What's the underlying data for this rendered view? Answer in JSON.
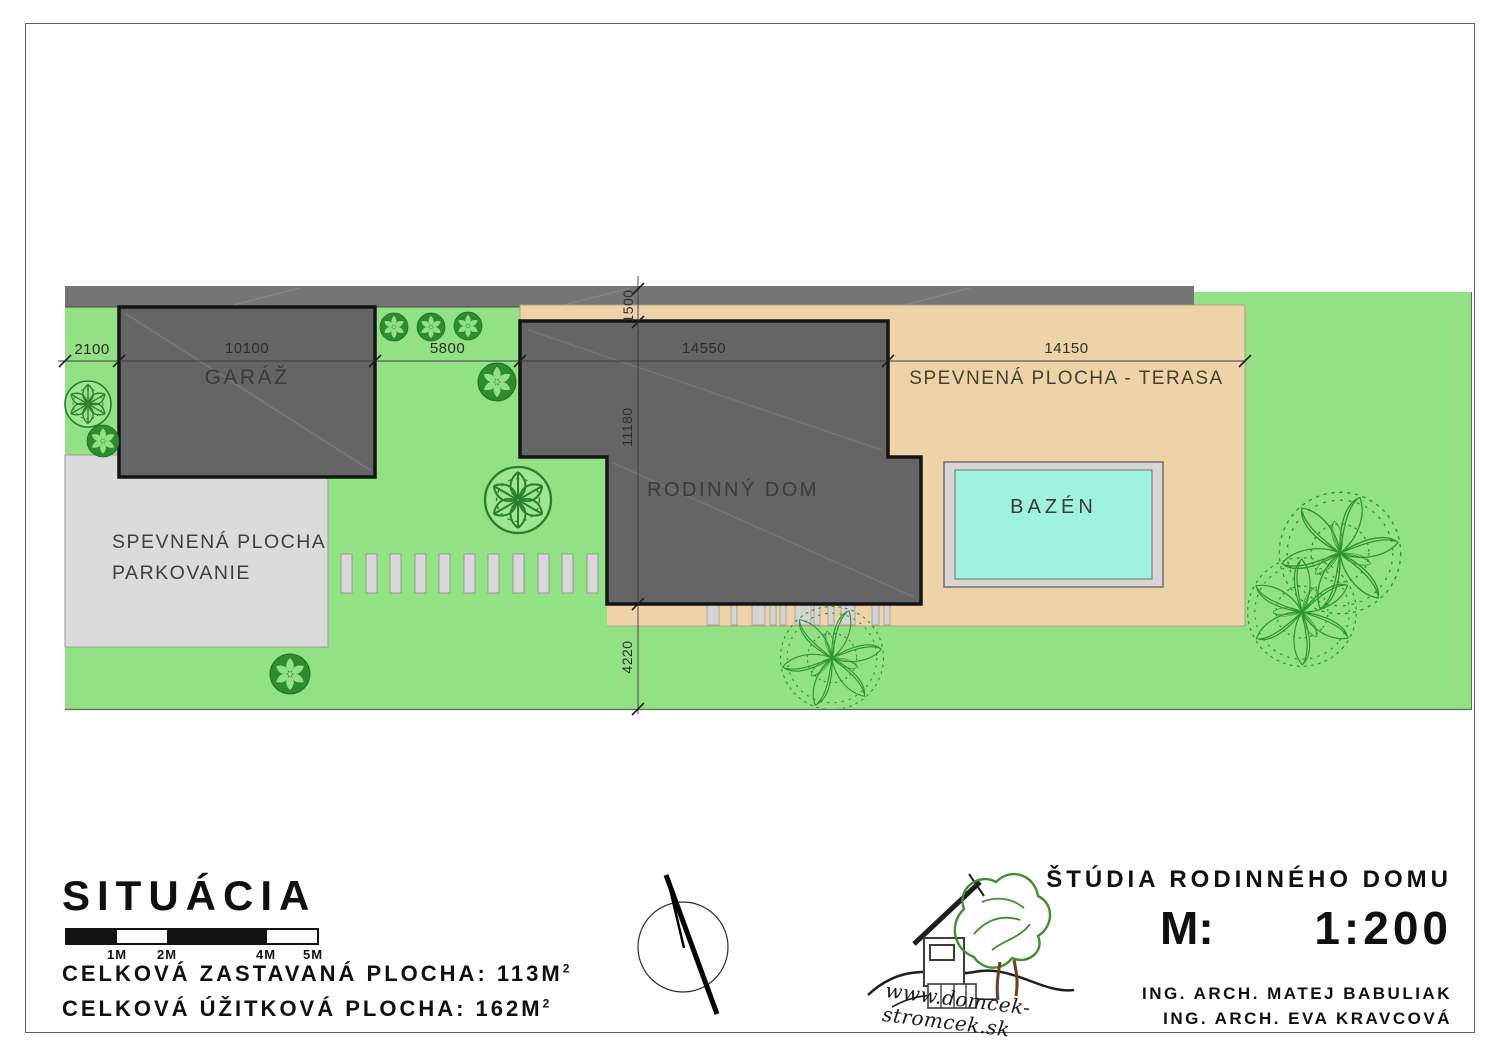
{
  "plan": {
    "area_labels": {
      "garage": "GARÁŽ",
      "house": "RODINNÝ DOM",
      "terrace": "SPEVNENÁ PLOCHA - TERASA",
      "pool": "BAZÉN",
      "parking_line1": "SPEVNENÁ PLOCHA",
      "parking_line2": "PARKOVANIE"
    },
    "dimensions_mm": {
      "left_offset": "2100",
      "garage_width": "10100",
      "garden_gap": "5800",
      "house_width": "14550",
      "terrace_width": "14150",
      "front_offset": "1500",
      "house_depth": "11180",
      "rear_offset": "4220"
    }
  },
  "title_block": {
    "title": "SITUÁCIA",
    "scale_labels": [
      "1M",
      "2M",
      "4M",
      "5M"
    ],
    "built_area": "CELKOVÁ ZASTAVANÁ PLOCHA: 113M",
    "built_area_sup": "2",
    "usable_area": "CELKOVÁ ÚŽITKOVÁ PLOCHA: 162M",
    "usable_area_sup": "2"
  },
  "project_block": {
    "title": "ŠTÚDIA RODINNÉHO DOMU",
    "scale_prefix": "M:",
    "scale_value": "1:200",
    "architect_1": "ING. ARCH. MATEJ BABULIAK",
    "architect_2": "ING. ARCH. EVA KRAVCOVÁ",
    "logo_text": "www.domcek-stromcek.sk"
  },
  "colors": {
    "lawn": "#92e185",
    "road": "#757575",
    "building": "#656565",
    "terrace": "#eed3a8",
    "parking": "#dbdbdb",
    "pool_water": "#9ff3dc",
    "pool_deck": "#d6d6d6",
    "tree_green": "#2e8b2e"
  }
}
